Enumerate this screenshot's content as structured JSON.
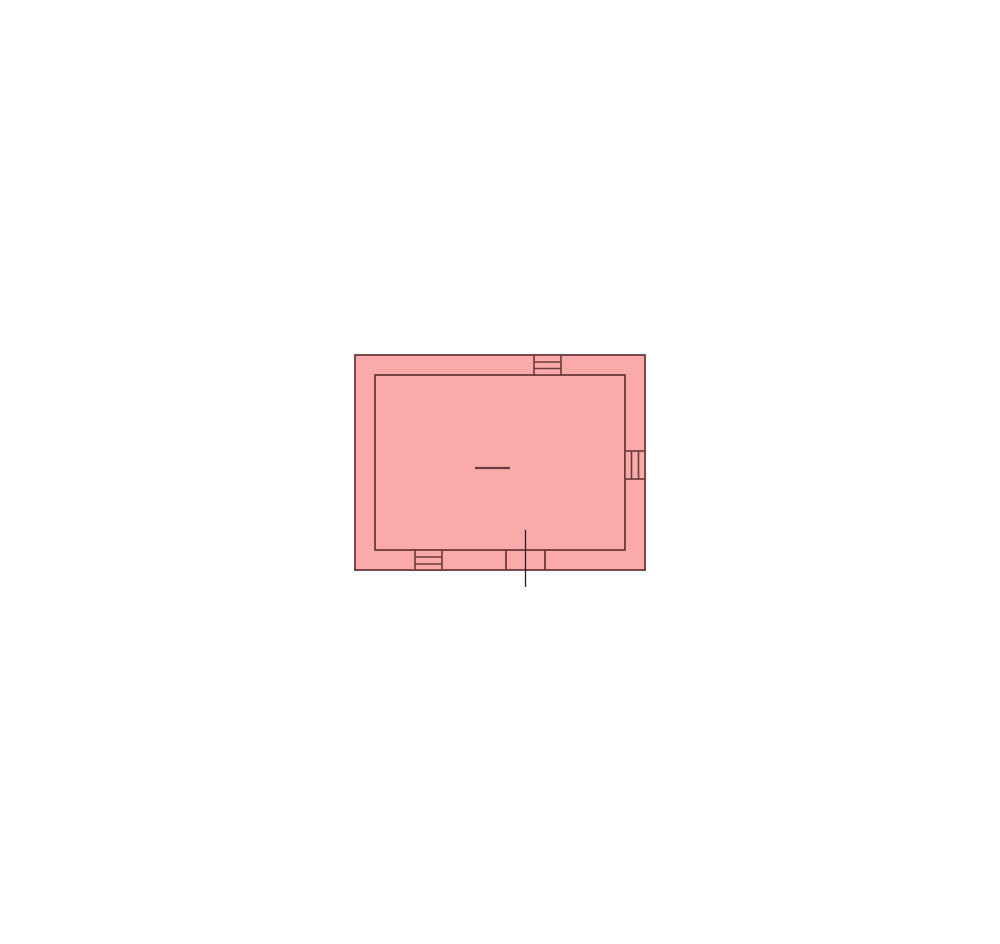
{
  "canvas": {
    "width": 1000,
    "height": 944,
    "background": "#ffffff"
  },
  "colors": {
    "room_fill": "#FBAAAA",
    "wall_stroke": "#6B3B3B",
    "door_line_stroke": "#222222"
  },
  "stroke_widths": {
    "wall": 1.8,
    "window": 1.6,
    "door_jamb": 1.8,
    "door_leaf": 1.3,
    "center_mark": 2.2
  },
  "floor_plan": {
    "outer_wall": {
      "x": 355,
      "y": 355,
      "width": 290,
      "height": 215
    },
    "inner_wall": {
      "x": 375,
      "y": 375,
      "width": 250,
      "height": 175
    },
    "windows": [
      {
        "name": "window-top",
        "orientation": "horizontal",
        "x": 534,
        "y": 355,
        "width": 27,
        "height": 20,
        "mullions": [
          362,
          368.5
        ]
      },
      {
        "name": "window-right",
        "orientation": "vertical",
        "x": 625,
        "y": 451,
        "width": 20,
        "height": 28,
        "mullions": [
          631.5,
          638.5
        ]
      },
      {
        "name": "window-bottom",
        "orientation": "horizontal",
        "x": 415,
        "y": 550,
        "width": 27,
        "height": 20,
        "mullions": [
          557,
          564
        ]
      }
    ],
    "door": {
      "jambs": [
        {
          "x": 506,
          "y1": 549.5,
          "y2": 570
        },
        {
          "x": 545,
          "y1": 549.5,
          "y2": 570
        }
      ],
      "leaf_line": {
        "x": 525.5,
        "y1": 530,
        "y2": 587
      }
    },
    "center_mark": {
      "x1": 475,
      "x2": 510,
      "y": 468
    }
  }
}
